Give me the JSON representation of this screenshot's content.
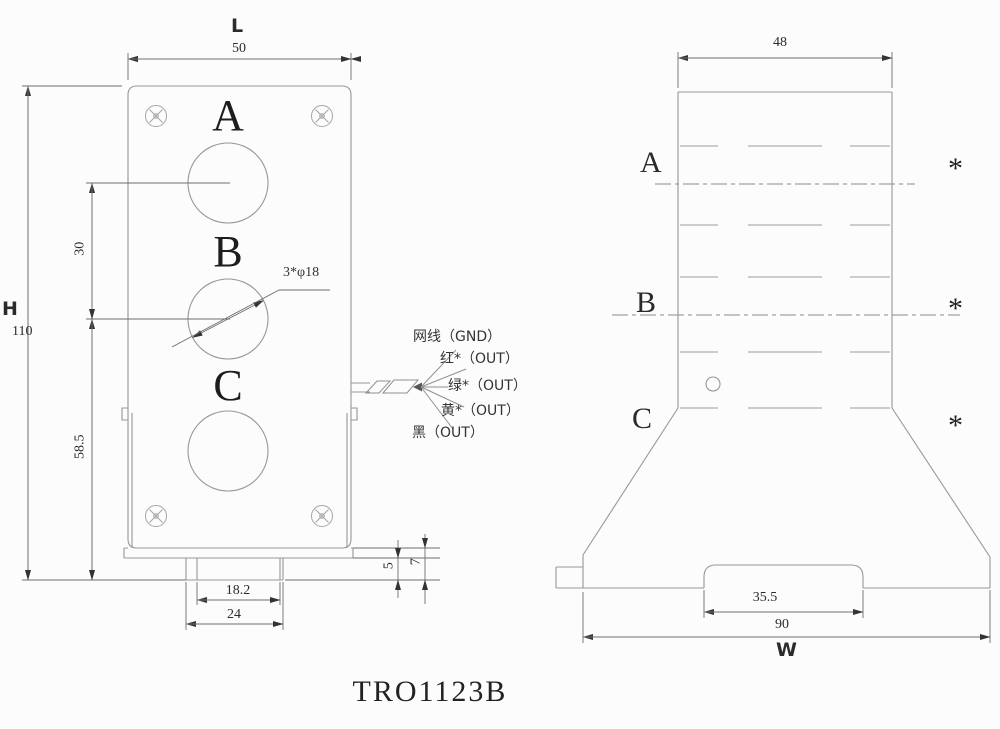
{
  "drawing": {
    "title": "TRO1123B",
    "front_view": {
      "width_label": "L",
      "width_value": "50",
      "height_label": "H",
      "height_value": "110",
      "hole_spacing_top": "30",
      "hole_spacing_bottom": "58.5",
      "hole_callout": "3*φ18",
      "holes": [
        {
          "label": "A"
        },
        {
          "label": "B"
        },
        {
          "label": "C"
        }
      ],
      "tab_inner_width": "18.2",
      "tab_outer_width": "24",
      "tab_height": "5",
      "base_height": "7",
      "wires": [
        {
          "label": "网线（GND）"
        },
        {
          "label": "红*（OUT）"
        },
        {
          "label": "绿*（OUT）"
        },
        {
          "label": "黄*（OUT）"
        },
        {
          "label": "黑（OUT）"
        }
      ]
    },
    "side_view": {
      "top_width": "48",
      "notch_width": "35.5",
      "base_width": "90",
      "base_width_label": "W",
      "sections": [
        {
          "label": "A",
          "marker": "*"
        },
        {
          "label": "B",
          "marker": "*"
        },
        {
          "label": "C",
          "marker": "*"
        }
      ]
    }
  }
}
